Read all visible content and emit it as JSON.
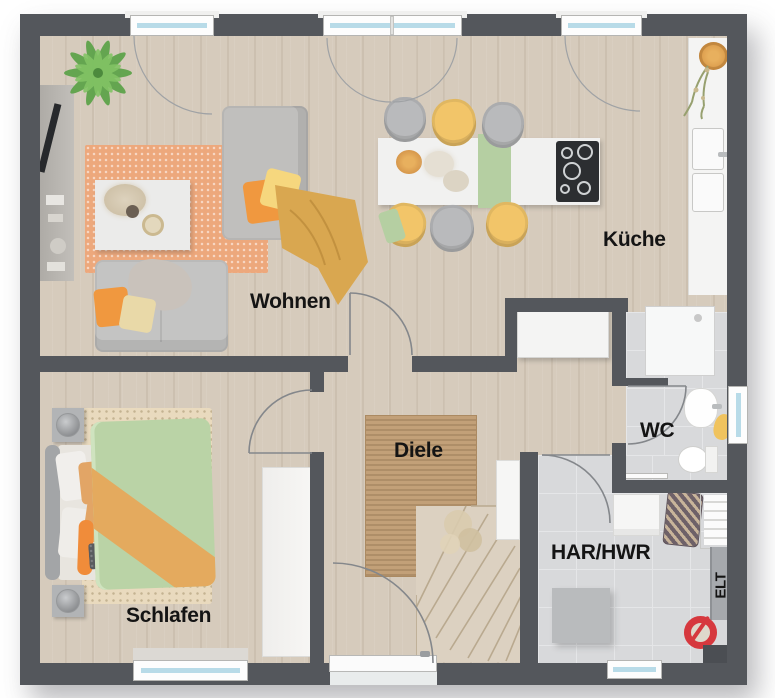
{
  "plan_type": "floor-plan",
  "rooms": {
    "wohnen": {
      "label": "Wohnen"
    },
    "kueche": {
      "label": "Küche"
    },
    "schlafen": {
      "label": "Schlafen"
    },
    "diele": {
      "label": "Diele"
    },
    "wc": {
      "label": "WC"
    },
    "har": {
      "label": "HAR/HWR"
    },
    "elt": {
      "label": "ELT"
    }
  },
  "colors": {
    "wall": "#54575c",
    "woodFloor": "#d6cbbc",
    "tile": "#d8d9db",
    "terracottaRug": "#eda87c",
    "juteRug": "#c2a078",
    "bedroomRug": "#e9dabe",
    "sofaGray": "#c0bfbd",
    "chairYellow": "#f2c569",
    "accentGreen": "#b5cfa2",
    "accentOrange": "#f0983f",
    "mustard": "#d9a750",
    "duvetGreen": "#bad3a6",
    "blanketOrange": "#e4aa5e",
    "windowGlass": "#b8dbe8",
    "red": "#d6383e",
    "stairs": "#dcd1c1",
    "label": "#141414"
  }
}
